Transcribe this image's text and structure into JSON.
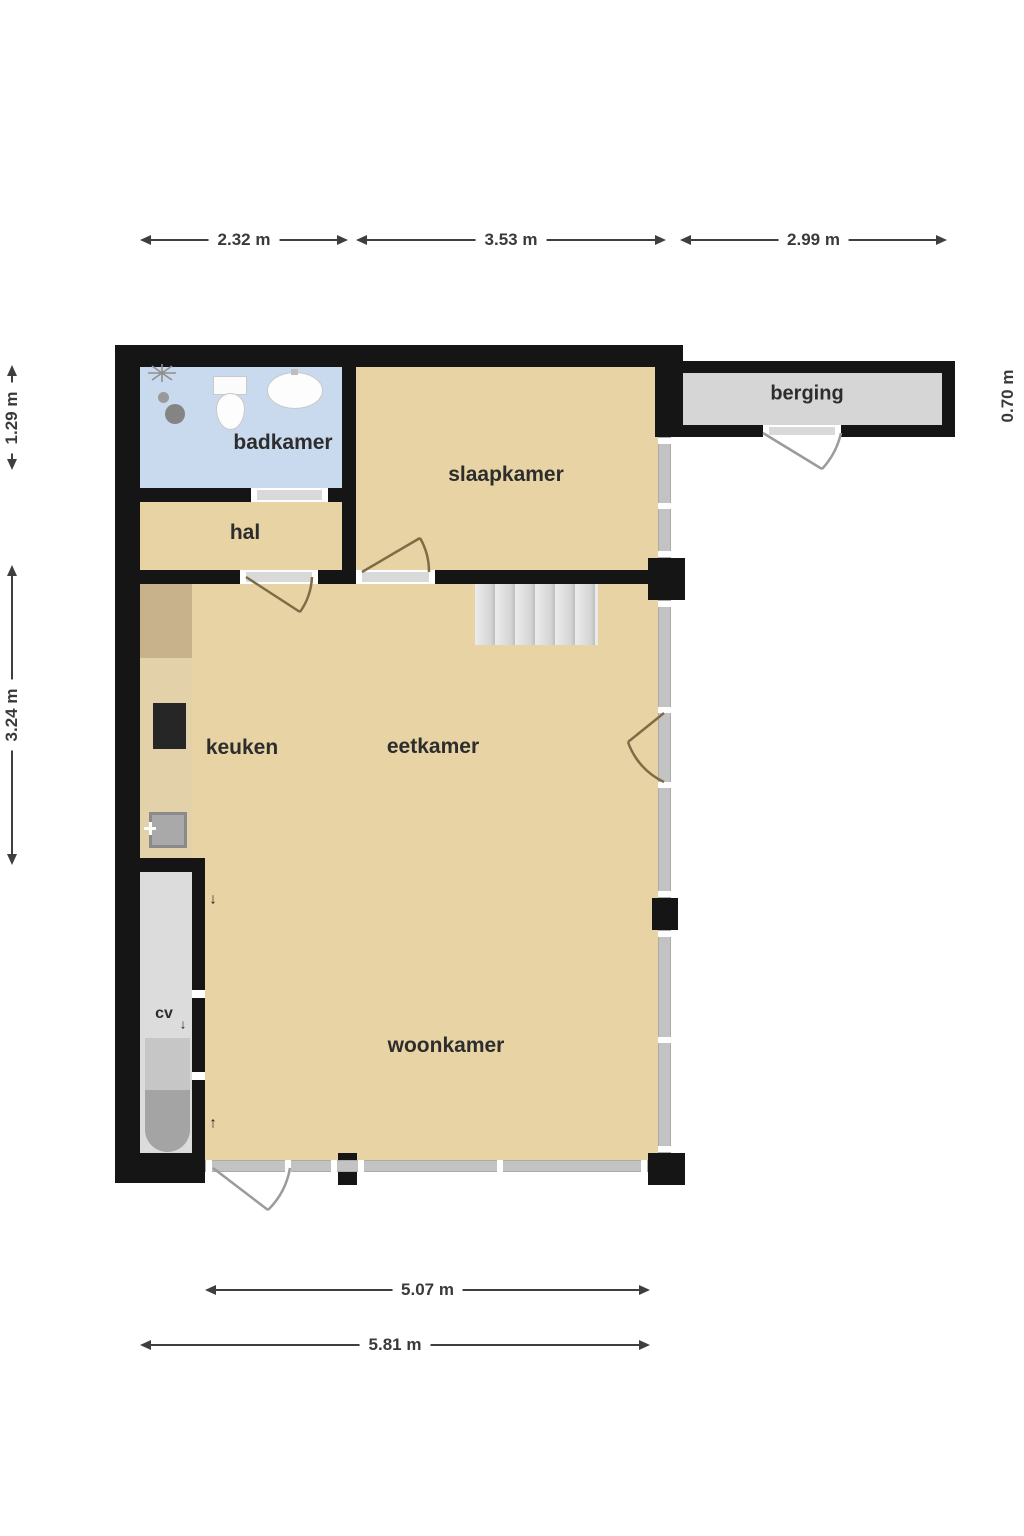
{
  "palette": {
    "wall": "#151515",
    "floor": "#e7d3a3",
    "bathroom_floor": "#c9daee",
    "storage_floor": "#d6d6d6",
    "cv_floor": "#dcdcdc",
    "window_glass": "#c3c3c3",
    "counter": "#e3d1aa",
    "counter_dark": "#c8b28c",
    "stove": "#262626",
    "stairs": "#d9d9d9",
    "door_arc_interior": "#7d6c45",
    "door_arc_exterior": "#9b9b9b",
    "dimension_text": "#3a3a3a"
  },
  "rooms": {
    "badkamer": "badkamer",
    "hal": "hal",
    "slaapkamer": "slaapkamer",
    "keuken": "keuken",
    "eetkamer": "eetkamer",
    "woonkamer": "woonkamer",
    "cv": "cv",
    "berging": "berging"
  },
  "dimensions": {
    "top": [
      "2.32 m",
      "3.53 m",
      "2.99 m"
    ],
    "left": [
      "1.29 m",
      "3.24 m"
    ],
    "right": "0.70 m",
    "bottom": [
      "5.07 m",
      "5.81 m"
    ]
  },
  "glyphs": {
    "arrow_down": "↓",
    "arrow_up": "↑"
  }
}
